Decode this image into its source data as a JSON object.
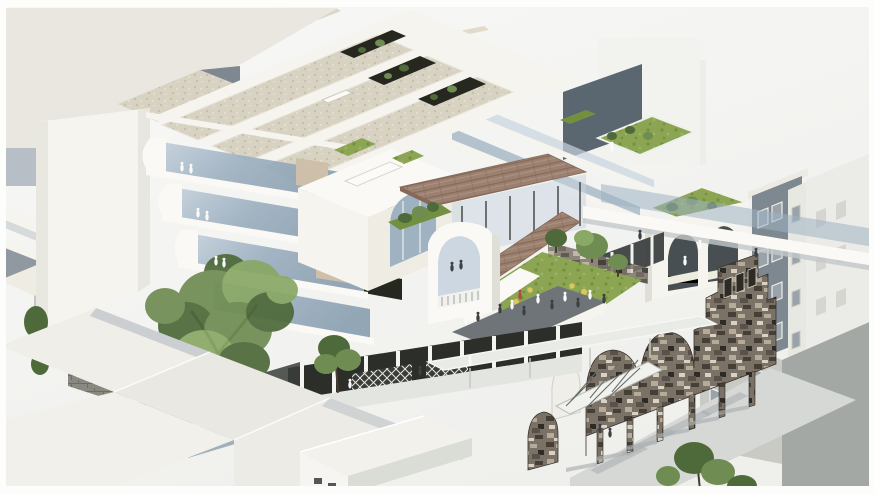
{
  "meta": {
    "type": "architectural-axonometric-rendering",
    "description": "Aerial axonometric render of an urban infill project: white stepped building with sectional cut and curved glass terraces, gravel roof bars with planted voids, central rooftop lawn garden with trees, yellow cafe tables and people, brown shingled canopy roofs over a glass pavilion, white arched parapet elements, a retained weathered stone heritage facade standing on slender piers, surrounded by pale grey context buildings and a large green tree."
  },
  "palette": {
    "bg_top": "#f7f7f5",
    "bg_bottom": "#efefec",
    "frame": "#fdfdfc",
    "roof_plane": "#e9e7e0",
    "wall_white": "#f5f4ef",
    "wall_bright": "#faf9f5",
    "wall_cream": "#efece4",
    "wall_shade": "#dfdfd8",
    "shadow_blue": "#a7b0b9",
    "shadow_gray": "#c3c8c9",
    "shadow_dark": "#7e8890",
    "dark_wall": "#5a6770",
    "void_dark": "#26271f",
    "glass_light": "#c7d3df",
    "glass_mid": "#9fb2c2",
    "glass_dark": "#7f93a4",
    "interior_tan": "#cdbfa9",
    "gravel": "#d8d2c3",
    "gravel_dot_dark": "#c4bdab",
    "gravel_dot_light": "#e8e3d6",
    "lawn": "#8ba553",
    "lawn_dark": "#72903f",
    "lawn_light": "#9cb468",
    "tree_light": "#8aa866",
    "tree_mid": "#6f8c52",
    "tree_dark": "#4f6a3a",
    "trunk": "#4a3c30",
    "canopy": "#9c8170",
    "canopy_dark": "#85695a",
    "canopy_light": "#ab9280",
    "stone": "#7b7267",
    "stone_dark": "#463f36",
    "stone_deep": "#2e2a25",
    "stone_light": "#b6ab97",
    "stone_pale": "#d9d2c4",
    "plaster": "#c9cac4",
    "gray_building": "#7e8890",
    "window_frame": "#eff0ec",
    "window_pane": "#9aa3aa",
    "ground": "#d6d8d5",
    "ground_shadow": "#aab0b2",
    "people_white": "#fafafa",
    "people_dark": "#3c4045",
    "people_red": "#b04a3a",
    "umbrella": "#d9c763",
    "arcade_dark": "#2c2e29",
    "truss": "#f1f1ed",
    "block_base": "#8a897f",
    "block_line": "#6f6e64",
    "lattice_line": "#e8e8e2"
  },
  "scene": {
    "regions": [
      {
        "name": "context-top-left",
        "description": "large pale context rooftop plane with blue-grey shadowed walls"
      },
      {
        "name": "left-slab-building",
        "description": "tall blank white slab wall"
      },
      {
        "name": "section-cut",
        "description": "four stepped floors cut open, curved white fascias, blue glass, tan interior walls, dark openings"
      },
      {
        "name": "roof-bars",
        "description": "parallel gravel-topped roof bars with dark planted courtyard voids and a skylight slot"
      },
      {
        "name": "right-upper-walls",
        "description": "dark feature wall, glass guardrail decks, upper roof lawns"
      },
      {
        "name": "center-volume",
        "description": "white volume with arched glass window and roof skylight slot"
      },
      {
        "name": "canopy-roofs",
        "description": "brown shingle canopy over glass pavilion and sloping walkway roof"
      },
      {
        "name": "rooftop-garden",
        "description": "lawn garden with trees, yellow tables, stone parapet, dark paved terrace, people"
      },
      {
        "name": "arch-tower",
        "description": "white arched parapet element with balustrade and two figures"
      },
      {
        "name": "right-loggia",
        "description": "white arcaded loggia with green roof and shrubs"
      },
      {
        "name": "neighbor-gray-building",
        "description": "slate grey four-storey building with white framed windows"
      },
      {
        "name": "far-right-building",
        "description": "pale neighbour block"
      },
      {
        "name": "elevated-walkway",
        "description": "long white walkway beam with glazing band"
      },
      {
        "name": "heritage-facade",
        "description": "retained weathered stone facade with arched parapets, stepped gable and slender piers"
      },
      {
        "name": "rear-plaster-building",
        "description": "grey plaster facade with paired windows behind the stone wall"
      },
      {
        "name": "ground-plane",
        "description": "light grey street surface with pier shadows"
      },
      {
        "name": "street-arcade",
        "description": "dark ground-floor arcade with thin white columns, lattice screens and white sloped canopy"
      },
      {
        "name": "truss-bridge",
        "description": "small white cross-braced truss element"
      },
      {
        "name": "foreground-roofs",
        "description": "low white context roofs and gabled house in the foreground"
      },
      {
        "name": "courtyard-stone-wall",
        "description": "block stone courtyard wall with lattice door and shrubs"
      },
      {
        "name": "large-tree",
        "description": "large green courtyard tree"
      },
      {
        "name": "people",
        "description": "tiny white, dark and red figures on terraces and walkways"
      }
    ]
  }
}
